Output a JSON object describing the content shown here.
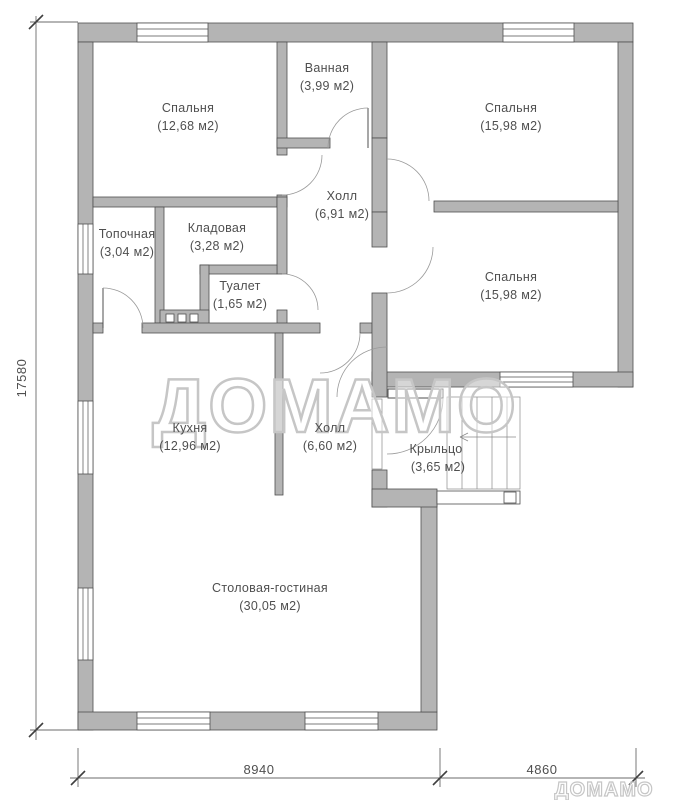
{
  "watermark": {
    "large": "ДОМАМО",
    "small": "ДОМАМО"
  },
  "rooms": {
    "bedroom_tl": {
      "name": "Спальня",
      "area": "(12,68 м2)"
    },
    "bathroom": {
      "name": "Ванная",
      "area": "(3,99 м2)"
    },
    "bedroom_tr": {
      "name": "Спальня",
      "area": "(15,98 м2)"
    },
    "hall_top": {
      "name": "Холл",
      "area": "(6,91 м2)"
    },
    "boiler": {
      "name": "Топочная",
      "area": "(3,04 м2)"
    },
    "storage": {
      "name": "Кладовая",
      "area": "(3,28 м2)"
    },
    "toilet": {
      "name": "Туалет",
      "area": "(1,65 м2)"
    },
    "bedroom_r": {
      "name": "Спальня",
      "area": "(15,98 м2)"
    },
    "kitchen": {
      "name": "Кухня",
      "area": "(12,96 м2)"
    },
    "hall_bottom": {
      "name": "Холл",
      "area": "(6,60 м2)"
    },
    "porch": {
      "name": "Крыльцо",
      "area": "(3,65 м2)"
    },
    "living": {
      "name": "Столовая-гостиная",
      "area": "(30,05 м2)"
    }
  },
  "dimensions": {
    "left": "17580",
    "bottom_left": "8940",
    "bottom_right": "4860"
  },
  "colors": {
    "wall_fill": "#b4b4b4",
    "wall_stroke": "#4f4f4f",
    "door_arc": "#9a9a9a",
    "text": "#4f4f4f",
    "watermark": "#c6c6c6"
  }
}
